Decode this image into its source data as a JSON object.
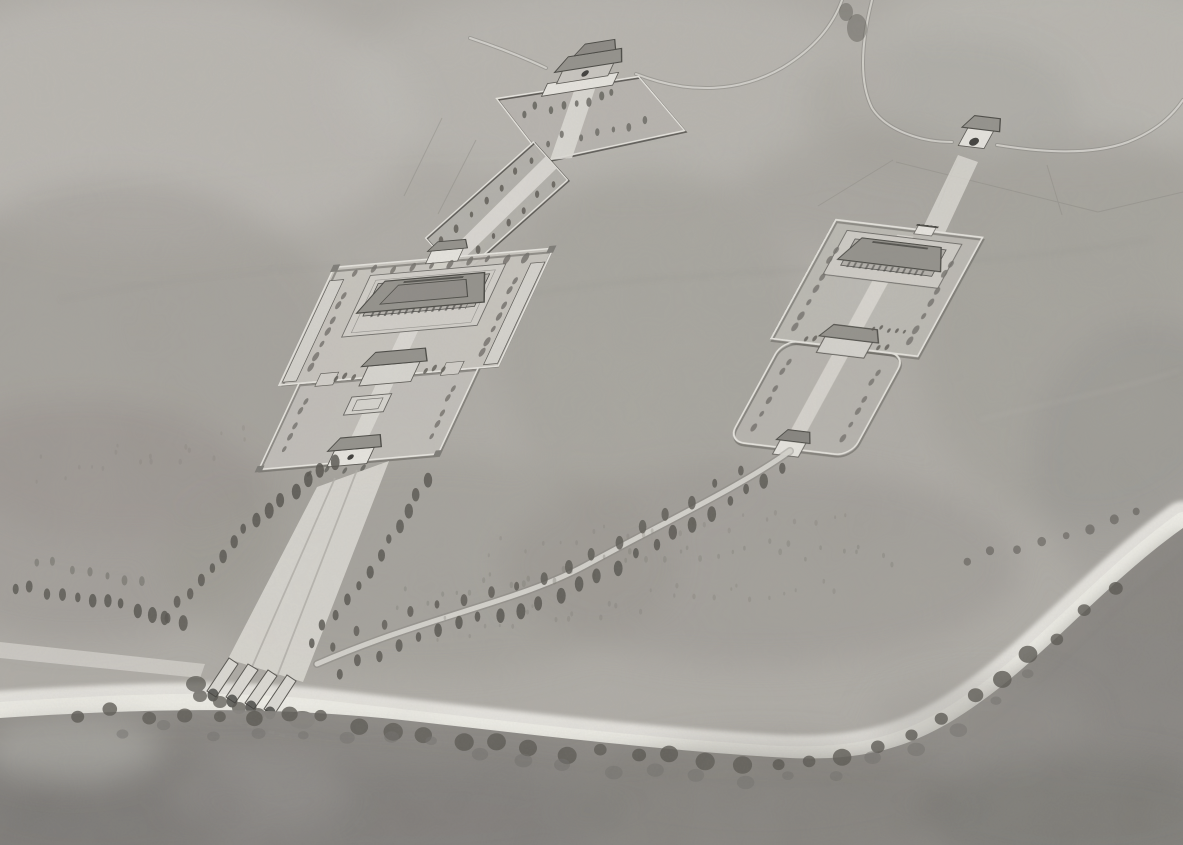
{
  "meta": {
    "kind": "illustration",
    "medium": "monochrome ink-and-wash watercolor, aerial bird's-eye perspective"
  },
  "scene": {
    "description": "Monochrome watercolor bird's-eye reconstruction of an ancient Chinese ceremonial site: two walled compounds with hip-roofed halls, galleries and gatehouses stand on a misty plain. A walled tree-planted causeway climbs from the western compound to a two-storey gatehouse on a terrace at the top; a second small gatehouse sits on a curving boundary road at the upper right. A broad tree-flanked spirit way descends from the western compound and crosses a river in the foreground over arched bridges, while a curving tree-lined road branches east to the southern gate of the eastern compound. Dark bands of trees follow the riverbanks and a dark wash fills the foreground meadow.",
    "elements": [
      {
        "name": "background-hills",
        "label": "mottled gray watercolor wash of open plain and hills"
      },
      {
        "name": "boundary-road",
        "label": "thin curving boundary road/wall sweeping across the top"
      },
      {
        "name": "north-gatehouse",
        "label": "two-storey hip-roofed gatehouse on walled terrace, top center"
      },
      {
        "name": "gate-terrace",
        "label": "walled terrace with trees and central path"
      },
      {
        "name": "walled-causeway",
        "label": "tree-planted walled causeway linking terrace to west compound"
      },
      {
        "name": "west-compound",
        "label": "large double-courtyard walled compound with main hall, galleries, inner and outer gates"
      },
      {
        "name": "east-compound",
        "label": "smaller two-court walled compound with hall, middle gate and south gate"
      },
      {
        "name": "northeast-gatehouse",
        "label": "small arched gatehouse on the boundary road, upper right"
      },
      {
        "name": "spirit-way",
        "label": "broad multi-lane avenue lined with cypress trees"
      },
      {
        "name": "approach-road",
        "label": "curving tree-lined road to the east compound"
      },
      {
        "name": "river",
        "label": "pale river crossing the foreground diagonally"
      },
      {
        "name": "bridges",
        "label": "four parallel arched bridges carrying the avenue over the river"
      },
      {
        "name": "riverbank-trees",
        "label": "dark tree bands along the near riverbank"
      },
      {
        "name": "foreground-meadow",
        "label": "dark gray foreground wash"
      },
      {
        "name": "field-lines",
        "label": "faint field boundary lines near the gates"
      }
    ],
    "palette": {
      "paper": "#b0ada7",
      "washLighter": "#c6c3bd",
      "washLight": "#bcb9b3",
      "washMid": "#9c9993",
      "washDark": "#8b8883",
      "foreground": "#85827d",
      "fgDark": "#6e6c67",
      "tree": "#56544e",
      "treeSoft": "#6e6c66",
      "scrub": "#79776f",
      "road": "#d8d6d0",
      "roadShadow": "#7f7d78",
      "river": "#e9e7e2",
      "riverCore": "#f1efe9",
      "court": "#c8c5bf",
      "path": "#dedcd6",
      "wallLight": "#e8e6e0",
      "wallDark": "#55534e",
      "roofGray": "#92908a",
      "roofDark": "#45443f",
      "ink": "#3a3936"
    }
  }
}
